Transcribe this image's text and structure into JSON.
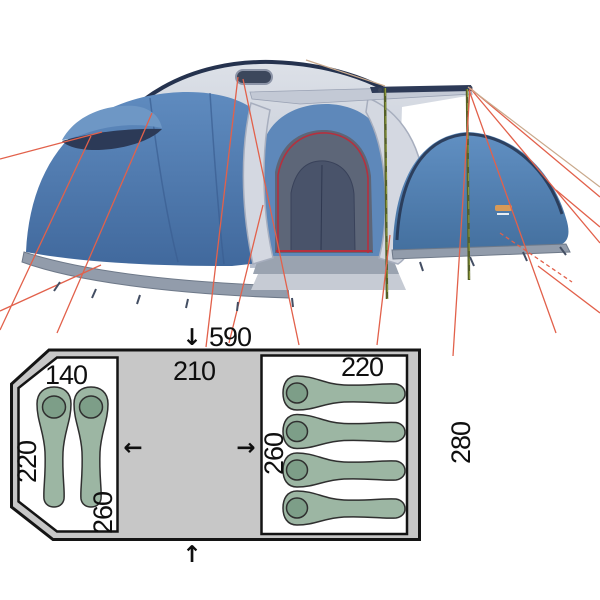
{
  "page": {
    "background": "#ffffff"
  },
  "tent_photo": {
    "colors": {
      "canvas_blue": "#4e7bb0",
      "canvas_blue_dark": "#41699d",
      "fly_gray": "#ccd1db",
      "fly_gray_dark": "#aab1c0",
      "trim_navy": "#25324e",
      "skirt_gray": "#929cab",
      "inner_dark": "#5d6678",
      "zipper_red": "#b5303e",
      "guy_line_red": "#e2614b",
      "guy_line_tan": "#c9a98c",
      "pole_olive": "#556027",
      "logo_orange": "#d89a57"
    }
  },
  "floor_plan": {
    "dimensions": {
      "total_width": "590",
      "vestibule_width": "210",
      "left_room_width": "140",
      "left_room_side": "220",
      "left_room_length": "260",
      "right_room_width": "220",
      "right_room_length": "260",
      "total_depth": "280"
    },
    "icons": {
      "arrow_down": "↓",
      "arrow_up": "↑",
      "arrow_left": "←",
      "arrow_right": "→"
    },
    "sleeping_bags": {
      "left_room_count": 2,
      "right_room_count": 4
    },
    "colors": {
      "floor_gray": "#c7c7c7",
      "room_white": "#ffffff",
      "outline_black": "#141414",
      "bag_green": "#9cb6a3",
      "bag_head_green": "#7d9e88"
    }
  }
}
